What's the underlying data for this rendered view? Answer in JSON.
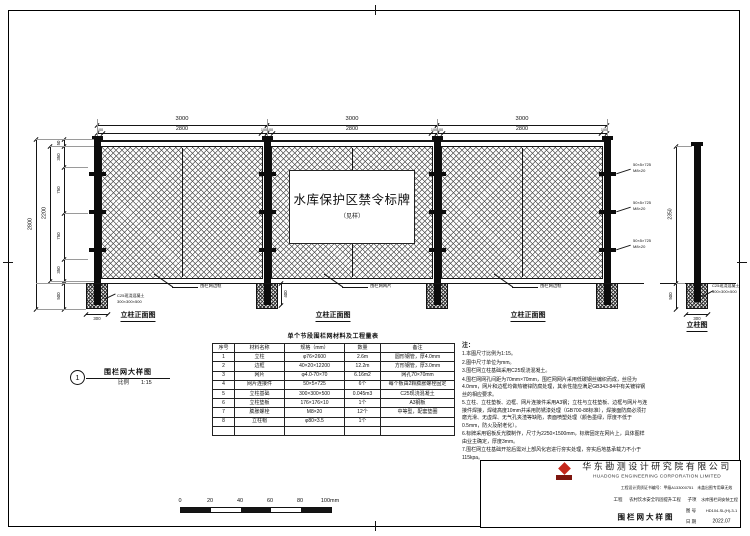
{
  "sheet": {
    "line_color": "#151515",
    "background": "#ffffff"
  },
  "drawing": {
    "sign": {
      "title": "水库保护区禁令标牌",
      "subtitle": "（见样）"
    },
    "dims": {
      "span": "3000",
      "panel": "2800",
      "post": "100",
      "height_total": "2800",
      "height_mesh": "2200",
      "segments": [
        "50",
        "350",
        "750",
        "750",
        "350"
      ],
      "foundation_depth": "500",
      "foundation_width": "300",
      "embed": "400",
      "single_height": "2350"
    },
    "labels": {
      "post_front_view": "立柱正面图",
      "single_post_view": "立柱图"
    },
    "callouts": {
      "frame": "围栏网边框",
      "mesh": "围栏网网片",
      "foundation_line1": "C25现浇混凝土",
      "foundation_line2": "300×300×500",
      "connector_line1": "50×5×725",
      "connector_line2": "M8×20"
    },
    "detail_ref": {
      "num": "1",
      "title": "围栏网大样图",
      "scale_label": "比例",
      "scale": "1:15"
    }
  },
  "scale_bar": {
    "ticks": [
      "0",
      "20",
      "40",
      "60",
      "80",
      "100mm"
    ]
  },
  "materials_table": {
    "title": "单个节段围栏网材料及工程量表",
    "headers": [
      "序号",
      "材料名称",
      "规格（mm）",
      "数量",
      "备注"
    ],
    "rows": [
      [
        "1",
        "立柱",
        "φ76×2600",
        "2.6m",
        "圆形钢管，厚4.0mm"
      ],
      [
        "2",
        "边框",
        "40×20×12200",
        "12.2m",
        "方形钢管，厚3.0mm"
      ],
      [
        "3",
        "网片",
        "φ4.0-70×70",
        "6.16m2",
        "网孔70×70mm"
      ],
      [
        "4",
        "网片连接件",
        "50×5×725",
        "6个",
        "每个板由2颗膨胀螺栓固定"
      ],
      [
        "5",
        "立柱基础",
        "300×300×500",
        "0.045m3",
        "C25现浇混凝土"
      ],
      [
        "6",
        "立柱垫板",
        "176×176×10",
        "1个",
        "A3钢板"
      ],
      [
        "7",
        "膨胀螺栓",
        "M8×20",
        "12个",
        "中等型，配套垫圈"
      ],
      [
        "8",
        "立柱帽",
        "φ80×3.5",
        "1个",
        ""
      ],
      [
        "",
        "",
        "",
        "",
        ""
      ]
    ]
  },
  "notes": {
    "title": "注：",
    "items": [
      "1.本图尺寸比例为1:15。",
      "2.图中尺寸单位为mm。",
      "3.围栏网立柱基础采用C25现浇混凝土。",
      "4.围栏网网孔间距为70mm×70mm，围栏网网片采用低碳钢丝编织而成，丝径为4.0mm，网片和边框均做热镀锌防腐处理，其余性能应满足GB343-84中有关镀锌钢丝的相应要求。",
      "5.立柱、立柱垫板、边框、网片连接件采用A3钢；立柱与立柱垫板、边框与网片与连接件焊接，焊缝高度10mm并采用防锈漆处理（GB700-88标准），焊接面防腐必须打磨光滑、无虚焊、无气孔夹渣等缺陷，表面喷塑处理（颜色墨绿，厚度不低于0.5mm，防火及耐老化）。",
      "6.标牌采用铝板反光膜制作，尺寸为2250×1500mm，标牌固定在网片上，具体图样由业主确定，厚度3mm。",
      "7.围栏网立柱基础开挖后需对上部风化岩进行夯实处理，夯实后地基承载力不小于115kpa。"
    ]
  },
  "title_block": {
    "accent": "#c5281c",
    "company_cn": "华东勘测设计研究院有限公司",
    "company_en": "HUADONG ENGINEERING CORPORATION LIMITED",
    "qualification": "工程设计资质证书编号：甲级A133000751　未盖出图专用章无效",
    "project_label": "工程",
    "project": "农村饮水安全巩固提升工程",
    "subitem_label": "子项",
    "subitem": "水库围栏网安装工程",
    "drawing_title": "围栏网大样图",
    "drawing_no_label": "图 号",
    "drawing_no": "HD104-SL(H)-3-1",
    "date_label": "日 期",
    "date": "2022.07",
    "rows": [
      {
        "l": "批 准",
        "n": "",
        "s": "",
        "l2": "",
        "v2": ""
      },
      {
        "l": "核 定",
        "n": "",
        "s": "",
        "l2": "",
        "v2": ""
      },
      {
        "l": "审 查",
        "n": "杨学军",
        "s": "杨学军",
        "l2": "专 业",
        "v2": "水 工"
      },
      {
        "l": "校 核",
        "n": "张荣军",
        "s": "张荣军",
        "l2": "阶 段",
        "v2": "施工图"
      },
      {
        "l": "设 计",
        "n": "吴志华",
        "s": "吴志华",
        "l2": "项目负责",
        "v2": "张荣军"
      },
      {
        "l": "制 图",
        "n": "吴志华",
        "s": "吴志华",
        "l2": "专业负责",
        "v2": "张荣军"
      }
    ]
  }
}
